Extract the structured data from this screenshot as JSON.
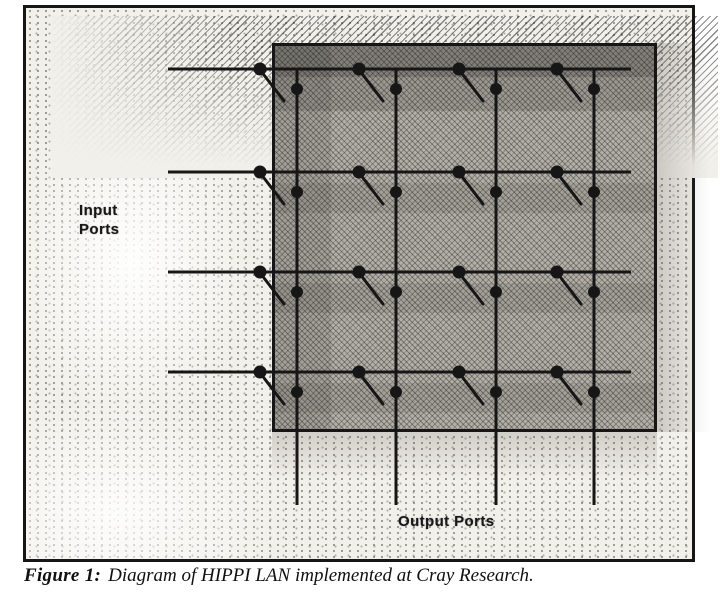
{
  "figure": {
    "caption": {
      "label": "Figure 1:",
      "text": "Diagram of HIPPI LAN implemented at Cray Research."
    },
    "input_ports_label_lines": [
      "Input",
      "Ports"
    ],
    "output_ports_label": "Output Ports"
  },
  "diagram": {
    "type": "crossbar-switch-diagram",
    "description": "4x4 HIPPI crossbar LAN: 4 horizontal input-port lines enter a shaded switch box from the left, 4 vertical output-port lines exit through the bottom; each of the 16 intersections carries an open crosspoint switch drawn as two contact dots and a hanging blade",
    "input_port_count": 4,
    "output_port_count": 4,
    "crosspoint_count": 16,
    "frame": {
      "x": 23,
      "y": 5,
      "width": 672,
      "height": 557
    },
    "switch_box": {
      "x": 246,
      "y": 35,
      "width": 385,
      "height": 389
    },
    "input_lines_y": [
      69,
      172,
      272,
      372
    ],
    "input_line_start_x": 168,
    "output_lines_x": [
      297,
      396,
      496,
      594
    ],
    "output_line_end_y": 505,
    "crosspoint": {
      "input_dot_dx": -37,
      "output_dot_dy": 20,
      "input_dot_radius": 6.5,
      "output_dot_radius": 6,
      "blade": [
        -33,
        6,
        -13,
        32
      ]
    },
    "colors": {
      "ink": "#161616",
      "paper": "#ffffff",
      "switch_fill": "#b3afa7"
    }
  }
}
